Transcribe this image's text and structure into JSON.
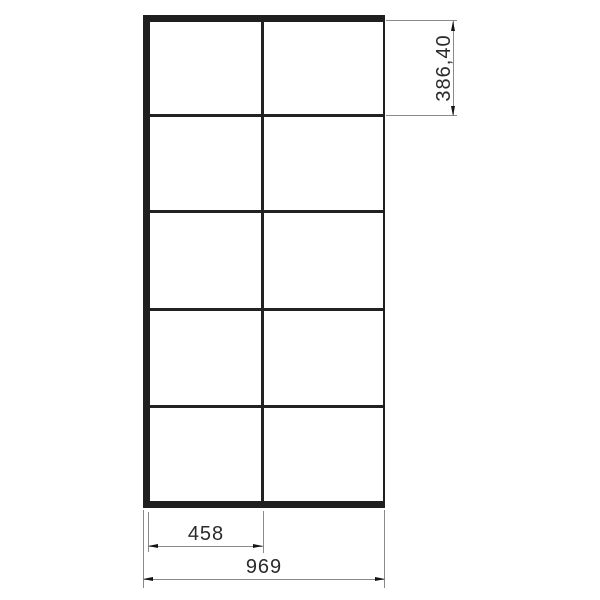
{
  "drawing": {
    "type": "technical-drawing",
    "subject": "gridded-frame-elevation",
    "grid": {
      "columns": 2,
      "rows": 5
    },
    "colors": {
      "background": "#ffffff",
      "frame": "#1f1f1f",
      "mullion": "#222222",
      "dimension_line": "#8a8a8a",
      "arrow": "#141414",
      "text": "#2b2b2b"
    },
    "dimensions": {
      "cell_height": {
        "label": "386,40",
        "orientation": "vertical"
      },
      "panel_width": {
        "label": "458",
        "orientation": "horizontal"
      },
      "total_width": {
        "label": "969",
        "orientation": "horizontal"
      }
    }
  }
}
